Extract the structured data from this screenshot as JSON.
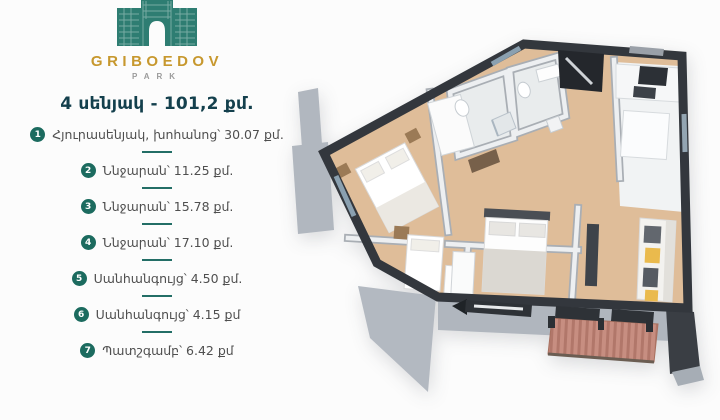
{
  "brand": {
    "name": "GRIBOEDOV",
    "subtitle": "PARK",
    "logo_icon": "arch-building-icon",
    "colors": {
      "gold": "#C7982E",
      "teal_building": "#2E7D72",
      "badge_teal": "#1C6B5F",
      "title_dark": "#14404D"
    }
  },
  "header": {
    "title": "4 սենյակ - 101,2 քմ."
  },
  "rooms": [
    {
      "num": "1",
      "label": "Հյուրասենյակ, խոհանոց՝ 30.07 քմ."
    },
    {
      "num": "2",
      "label": "Ննջարան՝ 11.25 քմ."
    },
    {
      "num": "3",
      "label": "Ննջարան՝ 15.78 քմ."
    },
    {
      "num": "4",
      "label": "Ննջարան՝ 17.10 քմ."
    },
    {
      "num": "5",
      "label": "Սանհանգույց՝ 4.50 քմ."
    },
    {
      "num": "6",
      "label": "Սանհանգույց՝ 4.15 քմ"
    },
    {
      "num": "7",
      "label": "Պատշգամբ՝ 6.42 քմ"
    }
  ],
  "floorplan": {
    "type": "3d-render-floor-plan",
    "rooms_count": 4,
    "total_area_label": "101,2 քմ.",
    "colors": {
      "outer_wall": "#33373D",
      "wood_floor": "#DFBD99",
      "kitchen_floor": "#F1F3F4",
      "exterior_ledge": "#B1B7BF",
      "balcony_railing": "#C68D80",
      "sofa_accent_yellow": "#EABA4D"
    }
  }
}
